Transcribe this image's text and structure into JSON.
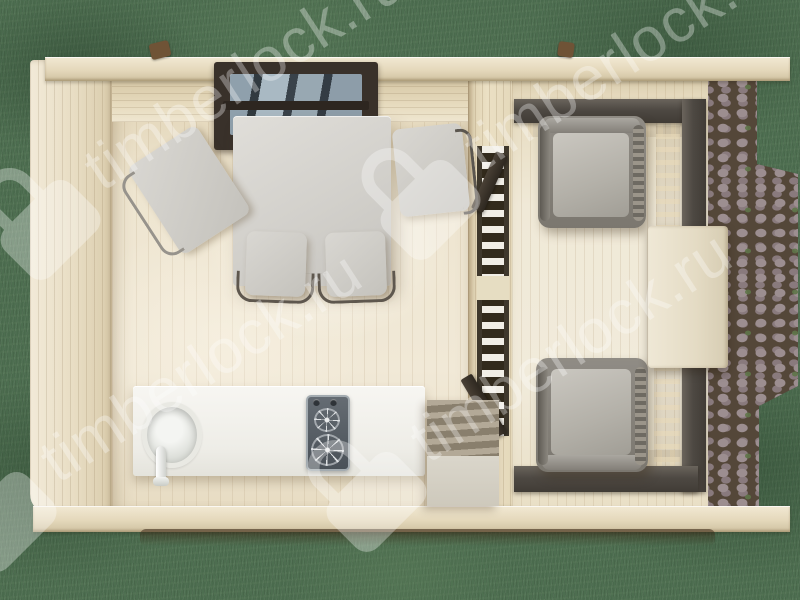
{
  "watermark": {
    "text": "timberlock.ru",
    "icon": "padlock-icon",
    "color": "#ffffff",
    "opacity": 0.32,
    "angle_deg": -33
  },
  "scene": {
    "type": "3d-render-top-down",
    "description": "Top-down 3D render of a small timber garden house with the roof removed: interior room with dining table, four chairs, kitchen counter with round sink, faucet and two-burner hob, shelf steps, a glazed partition with opened double doors, and a railed veranda with two grey armchairs and a side table; set on a grass lawn with a cobblestone patio on the right.",
    "areas": [
      "grass-lawn",
      "cobblestone-patio",
      "interior-room",
      "veranda"
    ]
  },
  "palette": {
    "grass": "#4d6e50",
    "timber_wall": "#ebe0c4",
    "timber_beam": "#e4d8bb",
    "floor_wood": "#ece3cd",
    "railing_dark": "#4e4943",
    "window_frame": "#39312a",
    "table_grey": "#d2d0cb",
    "cushion_grey": "#b3b0a8",
    "counter_white": "#f3f2ee",
    "stove_grey": "#565d64",
    "stone": "#9c8e90",
    "stone_joint": "#544739",
    "moss": "#5f7549"
  }
}
